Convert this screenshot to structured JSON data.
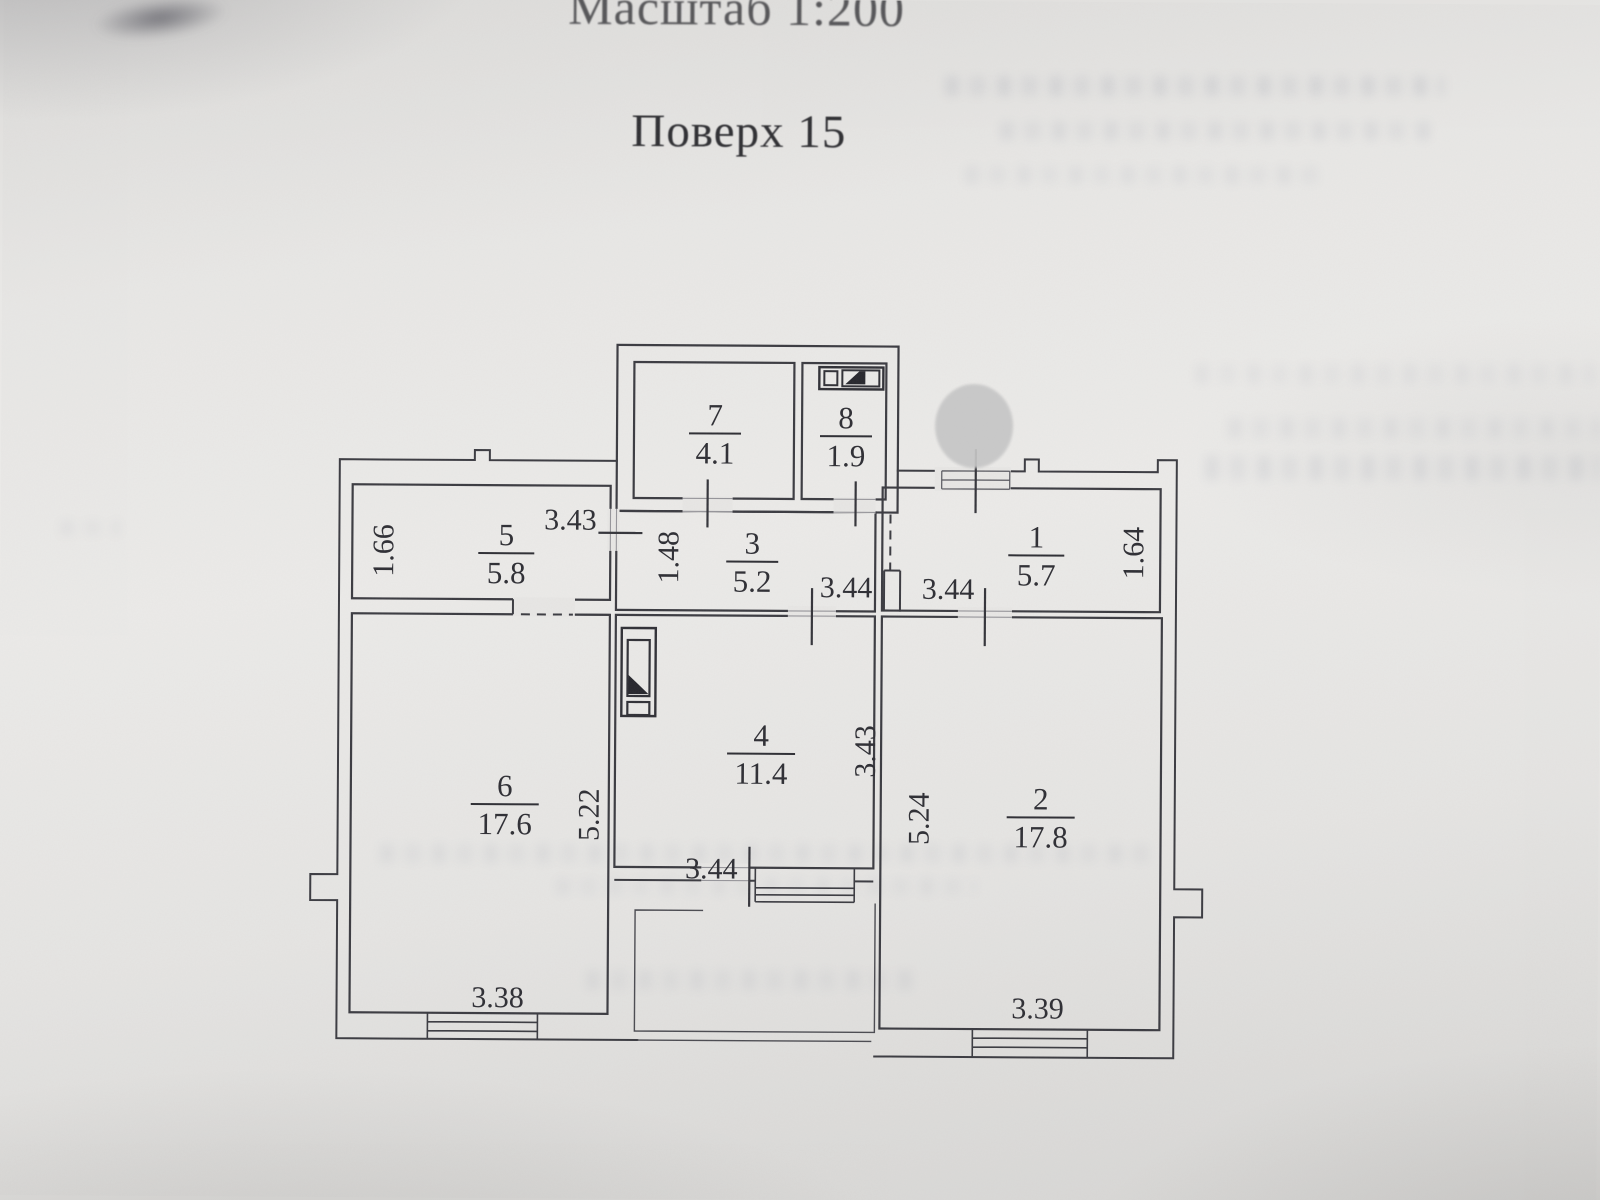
{
  "page": {
    "scale_title": "Масштаб 1:200",
    "floor_title": "Поверх 15"
  },
  "plan": {
    "rooms": [
      {
        "number": "1",
        "area": "5.7"
      },
      {
        "number": "2",
        "area": "17.8"
      },
      {
        "number": "3",
        "area": "5.2"
      },
      {
        "number": "4",
        "area": "11.4"
      },
      {
        "number": "5",
        "area": "5.8"
      },
      {
        "number": "6",
        "area": "17.6"
      },
      {
        "number": "7",
        "area": "4.1"
      },
      {
        "number": "8",
        "area": "1.9"
      }
    ],
    "dimensions": {
      "room5_top_width": "3.43",
      "room5_left_depth": "1.66",
      "hall_passage_width": "1.48",
      "corridor_width_left": "3.44",
      "corridor_width_right": "3.44",
      "room1_right_depth": "1.64",
      "room6_height": "5.22",
      "room4_height": "3.43",
      "room2_height": "5.24",
      "room4_bottom_width": "3.44",
      "room6_window_width": "3.38",
      "room2_window_width": "3.39"
    }
  }
}
